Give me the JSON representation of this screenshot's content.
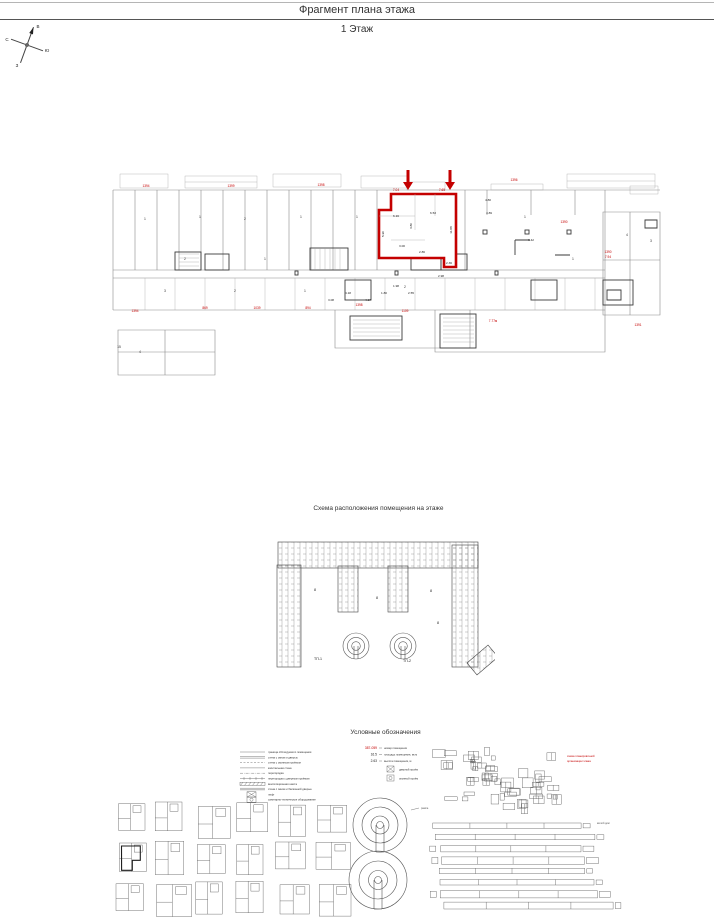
{
  "header": {
    "title": "Фрагмент плана этажа",
    "subtitle": "1 Этаж"
  },
  "compass": {
    "north": "С",
    "south": "Ю",
    "west": "З",
    "east": "В"
  },
  "plan": {
    "red_labels": [
      {
        "t": "1394",
        "x": 41,
        "y": 27
      },
      {
        "t": "1399",
        "x": 126,
        "y": 27
      },
      {
        "t": "1398",
        "x": 216,
        "y": 26
      },
      {
        "t": "7.04",
        "x": 291,
        "y": 31
      },
      {
        "t": "7.65",
        "x": 337,
        "y": 31
      },
      {
        "t": "1396",
        "x": 409,
        "y": 21
      },
      {
        "t": "1390",
        "x": 459,
        "y": 63
      },
      {
        "t": "1390",
        "x": 503,
        "y": 93
      },
      {
        "t": "7.94",
        "x": 503,
        "y": 98
      },
      {
        "t": "1394",
        "x": 30,
        "y": 152
      },
      {
        "t": "869",
        "x": 100,
        "y": 149
      },
      {
        "t": "1039",
        "x": 152,
        "y": 149
      },
      {
        "t": "894",
        "x": 203,
        "y": 149
      },
      {
        "t": "1398",
        "x": 254,
        "y": 146
      },
      {
        "t": "1109",
        "x": 300,
        "y": 152
      },
      {
        "t": "7.77м",
        "x": 388,
        "y": 162
      },
      {
        "t": "1391",
        "x": 533,
        "y": 166
      }
    ],
    "dim_labels": [
      {
        "t": "6.16",
        "x": 291,
        "y": 57
      },
      {
        "t": "6.53",
        "x": 328,
        "y": 54
      },
      {
        "t": "4.80",
        "x": 383,
        "y": 41
      },
      {
        "t": "4.89",
        "x": 384,
        "y": 54
      },
      {
        "t": "5.90",
        "x": 279,
        "y": 74,
        "r": -90
      },
      {
        "t": "3.80",
        "x": 307,
        "y": 66,
        "r": -90
      },
      {
        "t": "11.88",
        "x": 347,
        "y": 70,
        "r": -90
      },
      {
        "t": "3.00",
        "x": 297,
        "y": 87
      },
      {
        "t": "2.86",
        "x": 317,
        "y": 93
      },
      {
        "t": "2.36",
        "x": 344,
        "y": 104
      },
      {
        "t": "2.98",
        "x": 336,
        "y": 117
      },
      {
        "t": "6.42",
        "x": 426,
        "y": 81
      },
      {
        "t": "1.98",
        "x": 291,
        "y": 127
      },
      {
        "t": "2.55",
        "x": 306,
        "y": 134
      },
      {
        "t": "1.80",
        "x": 279,
        "y": 134
      },
      {
        "t": "4.17",
        "x": 263,
        "y": 141
      },
      {
        "t": "4.18",
        "x": 243,
        "y": 134
      },
      {
        "t": "3.08",
        "x": 226,
        "y": 141
      }
    ],
    "room_labels": [
      {
        "t": "1",
        "x": 40,
        "y": 60
      },
      {
        "t": "1",
        "x": 95,
        "y": 58
      },
      {
        "t": "2",
        "x": 140,
        "y": 60
      },
      {
        "t": "1",
        "x": 196,
        "y": 58
      },
      {
        "t": "1",
        "x": 252,
        "y": 58
      },
      {
        "t": "1",
        "x": 420,
        "y": 58
      },
      {
        "t": "4",
        "x": 35,
        "y": 193
      },
      {
        "t": "3",
        "x": 60,
        "y": 132
      },
      {
        "t": "2",
        "x": 130,
        "y": 132
      },
      {
        "t": "1",
        "x": 200,
        "y": 132
      },
      {
        "t": "2",
        "x": 300,
        "y": 128
      },
      {
        "t": "1",
        "x": 468,
        "y": 100
      },
      {
        "t": "4",
        "x": 522,
        "y": 76
      },
      {
        "t": "3",
        "x": 546,
        "y": 82
      },
      {
        "t": "2",
        "x": 80,
        "y": 100
      },
      {
        "t": "1",
        "x": 160,
        "y": 100
      },
      {
        "t": "15",
        "x": 14,
        "y": 188
      }
    ]
  },
  "site": {
    "title": "Схема расположения помещения на этаже",
    "markers": [
      {
        "t": "8",
        "x": 60,
        "y": 58
      },
      {
        "t": "8",
        "x": 122,
        "y": 66
      },
      {
        "t": "8",
        "x": 176,
        "y": 59
      },
      {
        "t": "8",
        "x": 183,
        "y": 91
      },
      {
        "t": "ТП-1",
        "x": 63,
        "y": 127
      },
      {
        "t": "ТП-2",
        "x": 152,
        "y": 129
      }
    ]
  },
  "legend": {
    "title": "Условные обозначения",
    "items": [
      {
        "sym": "thin",
        "label": "граница обследуемого помещения"
      },
      {
        "sym": "double",
        "label": "стена с окном и дверью"
      },
      {
        "sym": "dashed",
        "label": "стена с оконным проёмом"
      },
      {
        "sym": "thick",
        "label": "капитальная стена"
      },
      {
        "sym": "dashdot",
        "label": "перегородка"
      },
      {
        "sym": "ticks",
        "label": "перегородка с дверным проёмом"
      },
      {
        "sym": "hatch",
        "label": "вентиляционная шахта"
      },
      {
        "sym": "band",
        "label": "стена с окном и балконной дверью"
      },
      {
        "sym": "lift",
        "label": "лифт"
      },
      {
        "sym": "wc",
        "label": "санитарно-техническое оборудование"
      }
    ],
    "values": [
      {
        "value": "387-059",
        "label": "номер помещения",
        "red": true
      },
      {
        "value": "16.5",
        "label": "площадь помещения, кв.м",
        "red": false
      },
      {
        "value": "2.63",
        "label": "высота помещения, м",
        "red": false
      }
    ],
    "extra_symbols": [
      {
        "label": "дверной проём"
      },
      {
        "label": "оконный проём"
      }
    ],
    "cluster_note_lines": [
      "схема планировочной",
      "организации этажа"
    ],
    "strip_note": "жилой дом",
    "spiral_note": "рампа"
  }
}
